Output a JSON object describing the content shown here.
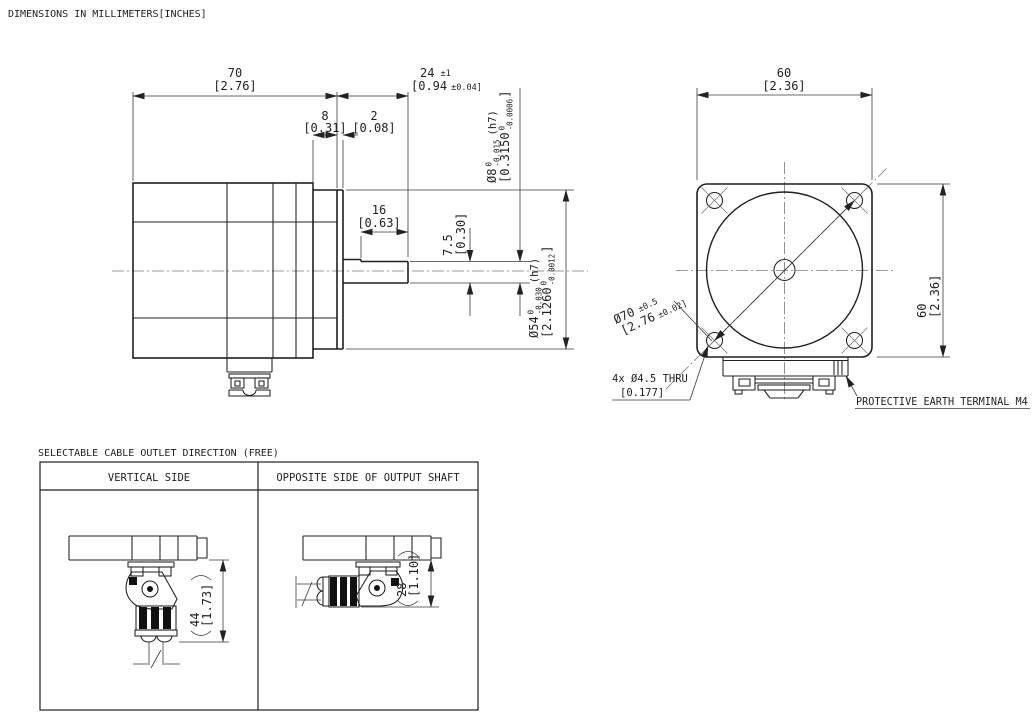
{
  "title": "DIMENSIONS IN MILLIMETERS[INCHES]",
  "colors": {
    "background": "#ffffff",
    "line": "#1f1f1f"
  },
  "side_view": {
    "dim70": {
      "mm": "70",
      "inch": "[2.76]"
    },
    "dim24": {
      "mm": "24",
      "tol": "±1",
      "inch": "[0.94",
      "inch_tol": "±0.04]"
    },
    "dim8": {
      "mm": "8",
      "inch": "[0.31]"
    },
    "dim2": {
      "mm": "2",
      "inch": "[0.08]"
    },
    "dim16": {
      "mm": "16",
      "inch": "[0.63]"
    },
    "dim7_5": {
      "mm": "7.5",
      "inch": "[0.30]"
    },
    "shaft_dia": {
      "mm": "Ø8",
      "tol_hi": "0",
      "tol_lo": "-0.015",
      "inch": "[0.3150",
      "inch_tol_hi": "0",
      "inch_tol_lo": "-0.0006",
      "inch_close": "]",
      "fit": "(h7)"
    },
    "pilot_dia": {
      "mm": "Ø54",
      "tol_hi": "0",
      "tol_lo": "-0.030",
      "inch": "[2.1260",
      "inch_tol_hi": "0",
      "inch_tol_lo": "-0.0012",
      "inch_close": "]",
      "fit": "(h7)"
    }
  },
  "front_view": {
    "dim60_top": {
      "mm": "60",
      "inch": "[2.36]"
    },
    "dim60_right": {
      "mm": "60",
      "inch": "[2.36]"
    },
    "bolt_circle": {
      "mm": "Ø70",
      "tol": "±0.5",
      "inch": "[2.76",
      "inch_tol": "±0.02]"
    },
    "mounting_holes": {
      "line1": "4x Ø4.5 THRU",
      "line2": "[0.177]"
    },
    "earth_terminal_label": "PROTECTIVE EARTH TERMINAL M4"
  },
  "cable_outlet": {
    "heading": "SELECTABLE CABLE OUTLET DIRECTION (FREE)",
    "columns": [
      "VERTICAL SIDE",
      "OPPOSITE SIDE OF OUTPUT SHAFT"
    ],
    "dim44": {
      "mm": "44",
      "inch": "[1.73]"
    },
    "dim28": {
      "mm": "28",
      "inch": "[1.10]"
    }
  }
}
